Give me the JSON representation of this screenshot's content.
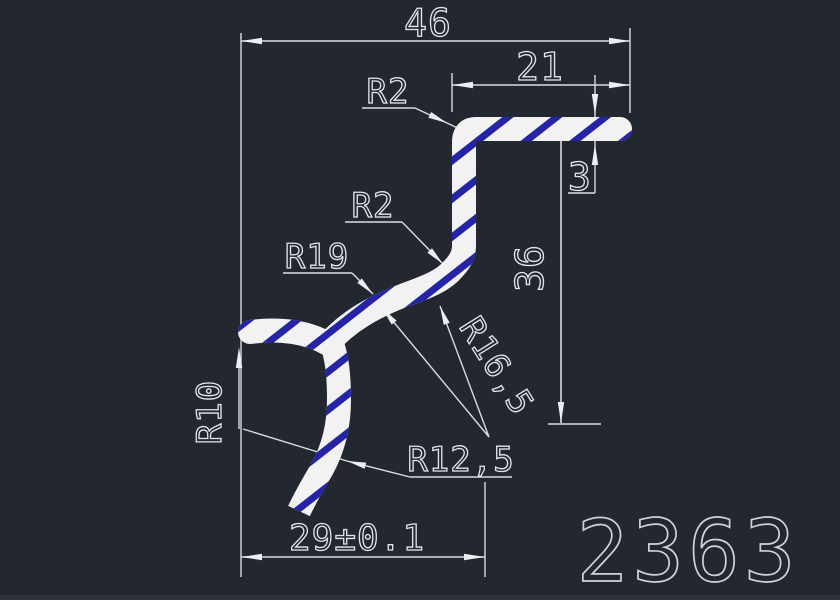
{
  "drawing": {
    "part_number": "2363",
    "dims": {
      "overall_width": "46",
      "upper_width": "21",
      "flange_thickness": "3",
      "right_height": "36",
      "bottom_width": "29±0.1"
    },
    "radii": {
      "top_corner": "R2",
      "mid_corner": "R2",
      "outer_curve": "R19",
      "inner_curve": "R16,5",
      "lower_inner": "R12,5",
      "hook_inner": "R10"
    },
    "colors": {
      "background": "#232730",
      "dimension_lines": "#d9dde2",
      "profile_wall": "#f2f2f2",
      "hatch": "#2424a4",
      "part_number_text": "#cfd3d8"
    }
  }
}
